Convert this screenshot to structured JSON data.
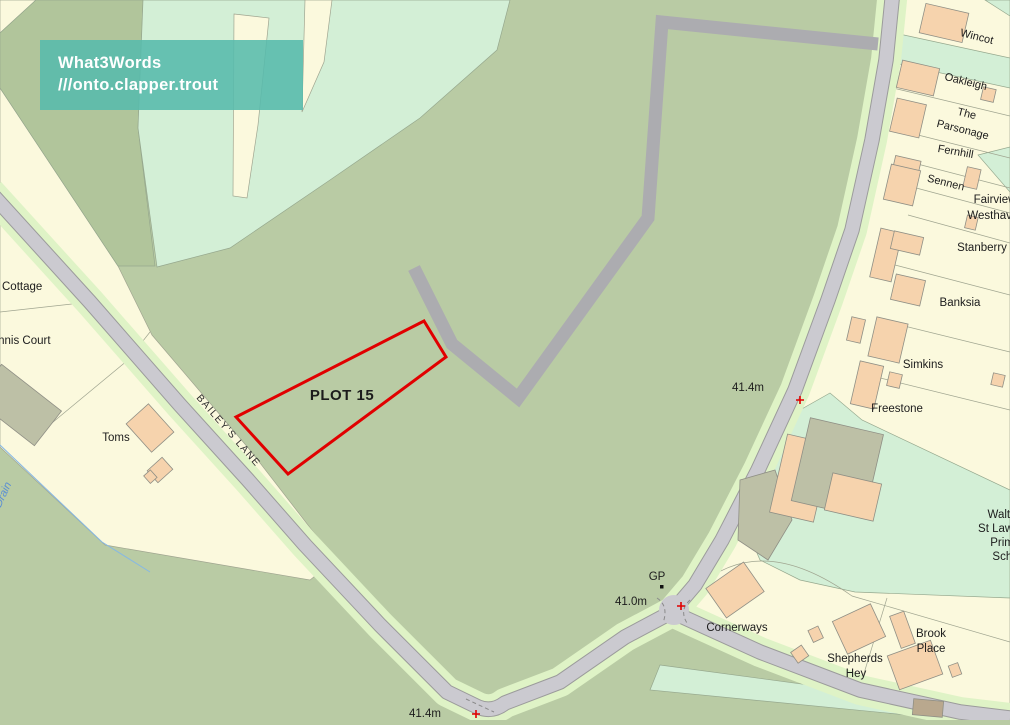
{
  "badge": {
    "title": "What3Words",
    "words": "///onto.clapper.trout",
    "bg_color": "#55bcae",
    "text_color": "#ffffff"
  },
  "map": {
    "colors": {
      "field_olive": "#b9cba4",
      "field_olive_dark": "#b1c59b",
      "plot_cream": "#fbf9dd",
      "grass_mint": "#d3efd6",
      "road_fill": "#cbcad0",
      "road_verge": "#dff3c6",
      "track_gray": "#acacb0",
      "building_peach": "#f6d3ad",
      "building_olive": "#bdc0a6",
      "plot_boundary_red": "#e10000",
      "drain_blue": "#86b8e4"
    },
    "plot": {
      "label": "PLOT 15"
    },
    "roads": {
      "bailey_lane": "BAILEY'S LANE"
    },
    "labels": {
      "cottage": "Cottage",
      "tennis_court": "Tennis Court",
      "toms": "Toms",
      "drain": "Drain",
      "spot_height_a": "41.4m",
      "gp": "GP",
      "spot_height_b": "41.0m",
      "spot_height_c": "41.4m",
      "cornerways": "Cornerways",
      "shepherds_1": "Shepherds",
      "shepherds_2": "Hey",
      "brook_1": "Brook",
      "brook_2": "Place",
      "school_1": "Waltham",
      "school_2": "St Lawrence",
      "school_3": "Primary",
      "school_4": "School",
      "freestone": "Freestone",
      "simkins": "Simkins",
      "banksia": "Banksia",
      "stanberry": "Stanberry",
      "westhaven": "Westhaven",
      "fairview": "Fairview",
      "sennen": "Sennen",
      "fernhill": "Fernhill",
      "parsonage_1": "The",
      "parsonage_2": "Parsonage",
      "oakleigh": "Oakleigh",
      "wincot": "Wincot"
    }
  }
}
